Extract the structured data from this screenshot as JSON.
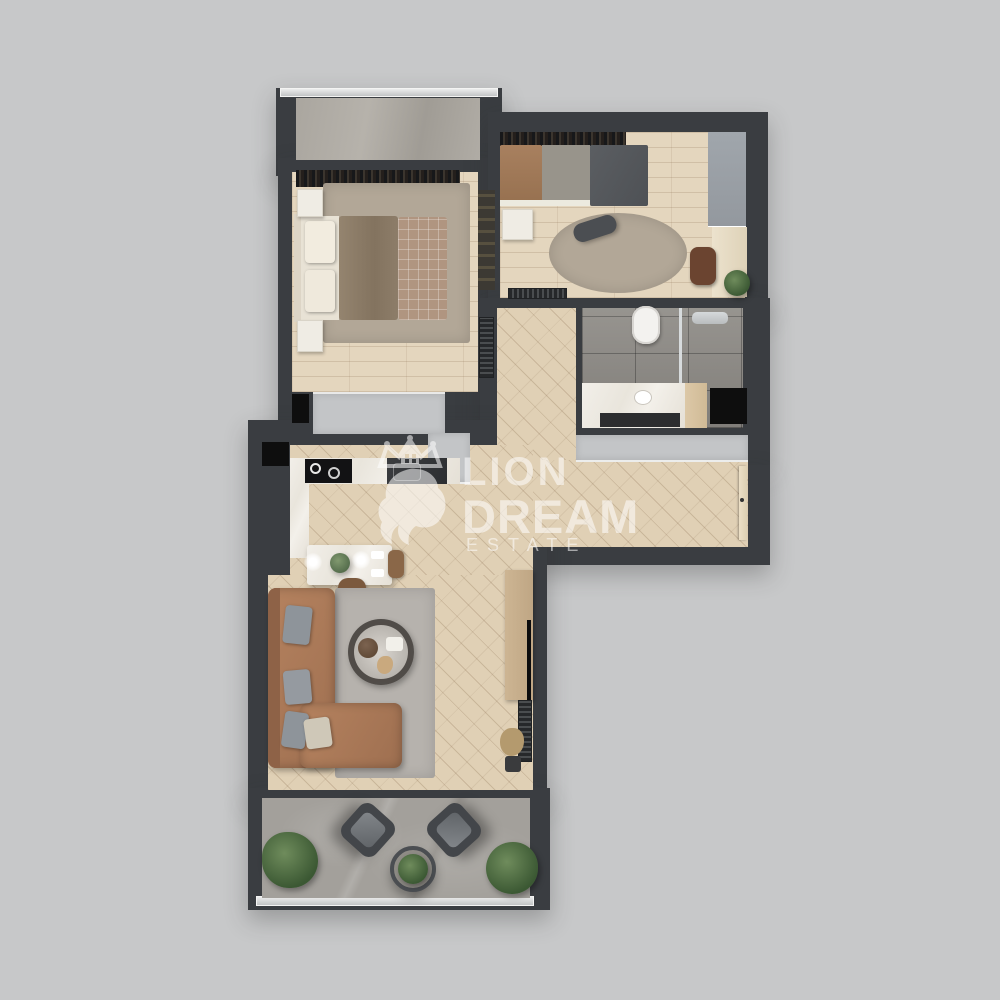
{
  "watermark": {
    "line1": "LION",
    "line2": "DREAM",
    "line3": "ESTATE"
  },
  "colors": {
    "background": "#c7c8c9",
    "wall": "#3a3d41",
    "wood": "#e4d6be",
    "herringbone": "#e0d0b5",
    "marble-white": "#efece4",
    "tile": "#8f8c87",
    "stone": "#a3a09b",
    "rug-taupe": "#b2a797",
    "rug-gray": "#b6b2ad",
    "sofa-brown": "#a97a5d",
    "closet-gray": "#c3c5c7",
    "plant-green": "#46633c",
    "shaft-black": "#0e0e0e",
    "watermark-white": "#ffffff"
  }
}
